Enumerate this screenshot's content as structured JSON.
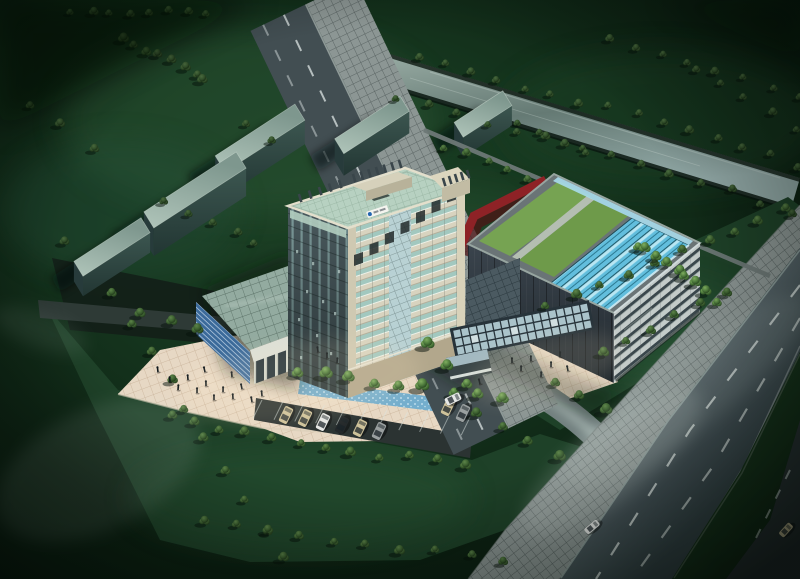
{
  "meta": {
    "title": "Night aerial rendering of a high-rise office complex with landscaped campus, canal and arterial road",
    "image_type": "3D architectural rendering",
    "view": "aerial oblique",
    "time_of_day": "night"
  },
  "palette": {
    "ground": "#0d2213",
    "ground_lit": "#2c5a37",
    "lawn": "#1e4128",
    "tree_dark_hi": "#4a6a3e",
    "tree_dark_lo": "#142610",
    "tree_bright_hi": "#7fae5f",
    "tree_bright_lo": "#24411d",
    "tree_mid_hi": "#5d8449",
    "tree_mid_lo": "#1d3418",
    "water_canal": "#8da39b",
    "water_feature": "#74aecd",
    "road_asphalt": "#46535a",
    "road_line": "#d6dedc",
    "sidewalk": "#8c9694",
    "plaza": "#e7d8c4",
    "median_green": "#1c3a22",
    "tower_stone": "#d8d3bf",
    "tower_glass": "#a2c8bf",
    "tower_roof": "#b7d1c1",
    "tower_shadow_face": "#4a5a5e",
    "box_wall_dark": "#3a444d",
    "box_facade": "#c3cbc9",
    "box_band": "#3a474c",
    "roof_lawn": "#76a352",
    "skylight_cyan": "#62bedd",
    "skylight_rim": "#a8dcec",
    "podium_glass": "#93aba0",
    "podium_blue": "#3b6a9a",
    "fascia_white": "#dcdfd6",
    "red_walkway": "#8e2226",
    "canopy_glass": "#b9d3da",
    "slab_top_hi": "#b0c5ba",
    "slab_top_lo": "#7e978e",
    "slab_side": "#2f4440",
    "slab_end": "#273b3b",
    "car_beige": "#cec29a",
    "car_white": "#e6e8e6",
    "car_dark": "#23282a",
    "car_grey": "#9aa0a0",
    "people": "#10181c",
    "glow_warm": "#ffe9c4",
    "glow_cool": "#dfefe8",
    "logo_blue": "#2466b0"
  },
  "scene": {
    "site_label": "office campus at night",
    "buildings": [
      {
        "id": "office-tower",
        "desc": "high-rise tower, cream stone grid facade with teal glass bands, shadowed west face, pale green flat roof with finned rooftop cores, small blue logo sign near parapet",
        "floors_visible": 14
      },
      {
        "id": "rnd-block",
        "desc": "low-rise block with two grass roof patches, cyan glass skylight band, light blue parapet strip, dark metal side wall, white banded front facade"
      },
      {
        "id": "glass-podium",
        "desc": "podium hall with sloped glass roof, white fascia, blue curtain wall with white stripes, entry stair"
      },
      {
        "id": "entry-canopy",
        "desc": "linear glass-grid entrance canopy with small gatehouse pavilion"
      },
      {
        "id": "red-walkway",
        "desc": "elevated red footbridge between tower and block"
      },
      {
        "id": "residential-slabs",
        "count": 5,
        "desc": "grey-green mid-rise slabs casting long shadows"
      }
    ],
    "landscape": {
      "canal": "tree-lined canal crossing the upper right",
      "plaza": "beige paved forecourt with pedestrians",
      "water_feature": "speckled blue channel fronting the tower with a tree bosque",
      "parking": "angled parking bays with parked cars",
      "lawns": "dark lawns with ordered rows of trees"
    },
    "roads": {
      "arterial": "dual carriageway lower right: dashed lanes, planted median, paver sidewalks",
      "secondary": "road lower left with dashed lanes and zebra crossing",
      "driveway": "curved lit site driveway joining the arterial"
    },
    "counts": {
      "parked_cars": 8,
      "moving_cars": 3,
      "pedestrians": 25
    }
  }
}
